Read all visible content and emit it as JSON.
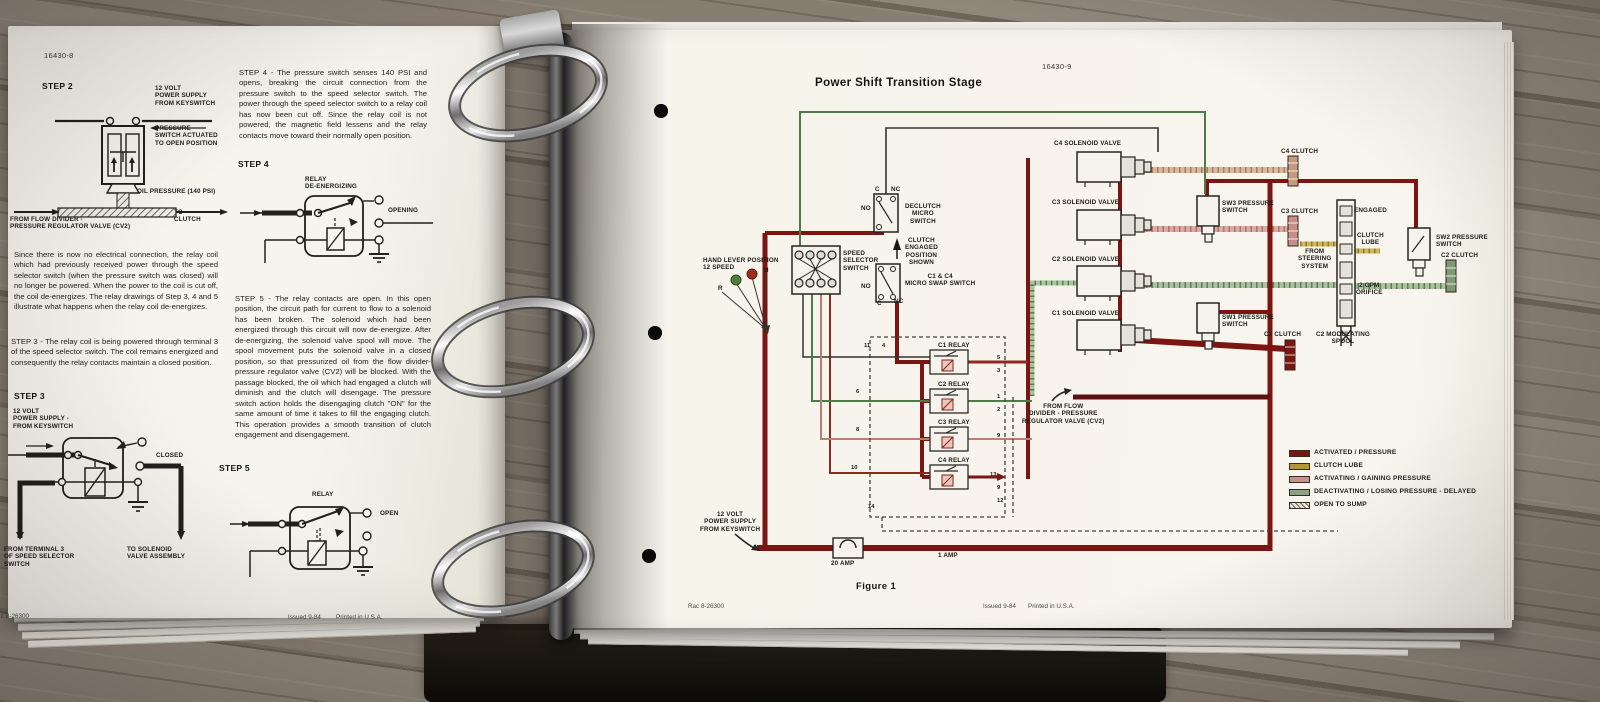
{
  "left_page": {
    "page_number": "16430-8",
    "step2": {
      "heading": "STEP 2",
      "power": "12 VOLT\nPOWER SUPPLY\nFROM KEYSWITCH",
      "pressure_switch": "PRESSURE\nSWITCH ACTUATED\nTO OPEN POSITION",
      "oil_pressure": "OIL PRESSURE (140 PSI)",
      "from_flow": "FROM FLOW DIVIDER -\nPRESSURE REGULATOR VALVE (CV2)",
      "to_clutch": "TO\nCLUTCH"
    },
    "para_since": "Since there is now no electrical connection, the relay coil which had previously received power through the speed selector switch (when the pressure switch was closed) will no longer be powered. When the power to the coil is cut off, the coil de-energizes. The relay drawings of Step 3, 4 and 5 illustrate what happens when the relay coil de-energizes.",
    "para_step3": "STEP 3 - The relay coil is being powered through terminal 3 of the speed selector switch. The coil remains energized and consequently the relay contacts maintain a closed position.",
    "step3": {
      "heading": "STEP 3",
      "power": "12 VOLT\nPOWER SUPPLY -\nFROM KEYSWITCH",
      "closed": "CLOSED",
      "from_terminal": "FROM TERMINAL 3\nOF SPEED SELECTOR\nSWITCH",
      "to_solenoid": "TO SOLENOID\nVALVE ASSEMBLY"
    },
    "para_step4": "STEP 4 - The pressure switch senses 140 PSI and opens, breaking the circuit connection from the pressure switch to the speed selector switch. The power through the speed selector switch to a relay coil has now been cut off. Since the relay coil is not powered, the magnetic field lessens and the relay contacts move toward their normally open position.",
    "step4": {
      "heading": "STEP 4",
      "relay": "RELAY\nDE-ENERGIZING",
      "opening": "OPENING"
    },
    "para_step5": "STEP 5 - The relay contacts are open. In this open position, the circuit path for current to flow to a solenoid has been broken. The solenoid which had been energized through this circuit will now de-energize. After de-energizing, the solenoid valve spool will move. The spool movement puts the solenoid valve in a closed position, so that pressurized oil from the flow divider-pressure regulator valve (CV2) will be blocked. With the passage blocked, the oil which had engaged a clutch will diminish and the clutch will disengage. The pressure switch action holds the disengaging clutch \"ON\" for the same amount of time it takes to fill the engaging clutch. This operation provides a smooth transition of clutch engagement and disengagement.",
    "step5": {
      "heading": "STEP 5",
      "relay": "RELAY",
      "open": "OPEN"
    },
    "footer": {
      "code": "c 8-26300",
      "issued": "Issued 9-84",
      "printed": "Printed in U.S.A."
    }
  },
  "right_page": {
    "page_number": "16430-9",
    "title": "Power Shift Transition Stage",
    "figure": "Figure 1",
    "footer": {
      "code": "Rac 8-26300",
      "issued": "Issued 9-84",
      "printed": "Printed in U.S.A."
    },
    "labels": {
      "hand_lever": "HAND LEVER POSITION\n12 SPEED",
      "pos_h": "H",
      "pos_r": "R",
      "speed_selector": "SPEED\nSELECTOR\nSWITCH",
      "declutch": "DECLUTCH\nMICRO\nSWITCH",
      "declutch_c": "C",
      "declutch_nc": "NC",
      "declutch_no": "NO",
      "clutch_engaged": "CLUTCH\nENGAGED\nPOSITION\nSHOWN",
      "swap": "C1 & C4\nMICRO SWAP SWITCH",
      "swap_no": "NO",
      "swap_c": "C",
      "swap_nc": "NC",
      "c4_sol": "C4 SOLENOID VALVE",
      "c3_sol": "C3 SOLENOID VALVE",
      "c2_sol": "C2 SOLENOID VALVE",
      "c1_sol": "C1 SOLENOID VALVE",
      "sw3": "SW3 PRESSURE\nSWITCH",
      "sw2": "SW2 PRESSURE\nSWITCH",
      "sw1": "SW1 PRESSURE\nSWITCH",
      "c4_clutch": "C4 CLUTCH",
      "c3_clutch": "C3 CLUTCH",
      "c2_clutch": "C2 CLUTCH",
      "c1_clutch": "C1 CLUTCH",
      "engaged": "ENGAGED",
      "clutch_lube": "CLUTCH\nLUBE",
      "from_steering": "FROM\nSTEERING\nSYSTEM",
      "gpm": "2 GPM\nORIFICE",
      "c2_spool": "C2 MODULATING\nSPOOL",
      "relay1": "C1 RELAY",
      "relay2": "C2 RELAY",
      "relay3": "C3 RELAY",
      "relay4": "C4 RELAY",
      "from_flow": "FROM FLOW\nDIVIDER - PRESSURE\nREGULATOR VALVE (CV2)",
      "power": "12 VOLT\nPOWER SUPPLY\nFROM KEYSWITCH",
      "amp20": "20 AMP",
      "amp1": "1 AMP"
    },
    "wire_numbers": [
      "11",
      "4",
      "6",
      "8",
      "10",
      "5",
      "3",
      "1",
      "2",
      "9",
      "13",
      "9",
      "12",
      "14"
    ],
    "legend": {
      "items": [
        {
          "label": "ACTIVATED / PRESSURE",
          "color": "#7a1512"
        },
        {
          "label": "CLUTCH LUBE",
          "color": "#b1993b"
        },
        {
          "label": "ACTIVATING / GAINING PRESSURE",
          "color": "#c9938d"
        },
        {
          "label": "DEACTIVATING / LOSING PRESSURE - DELAYED",
          "color": "#89a47e"
        },
        {
          "label": "OPEN TO SUMP",
          "color": "#eae7dd"
        }
      ]
    }
  }
}
